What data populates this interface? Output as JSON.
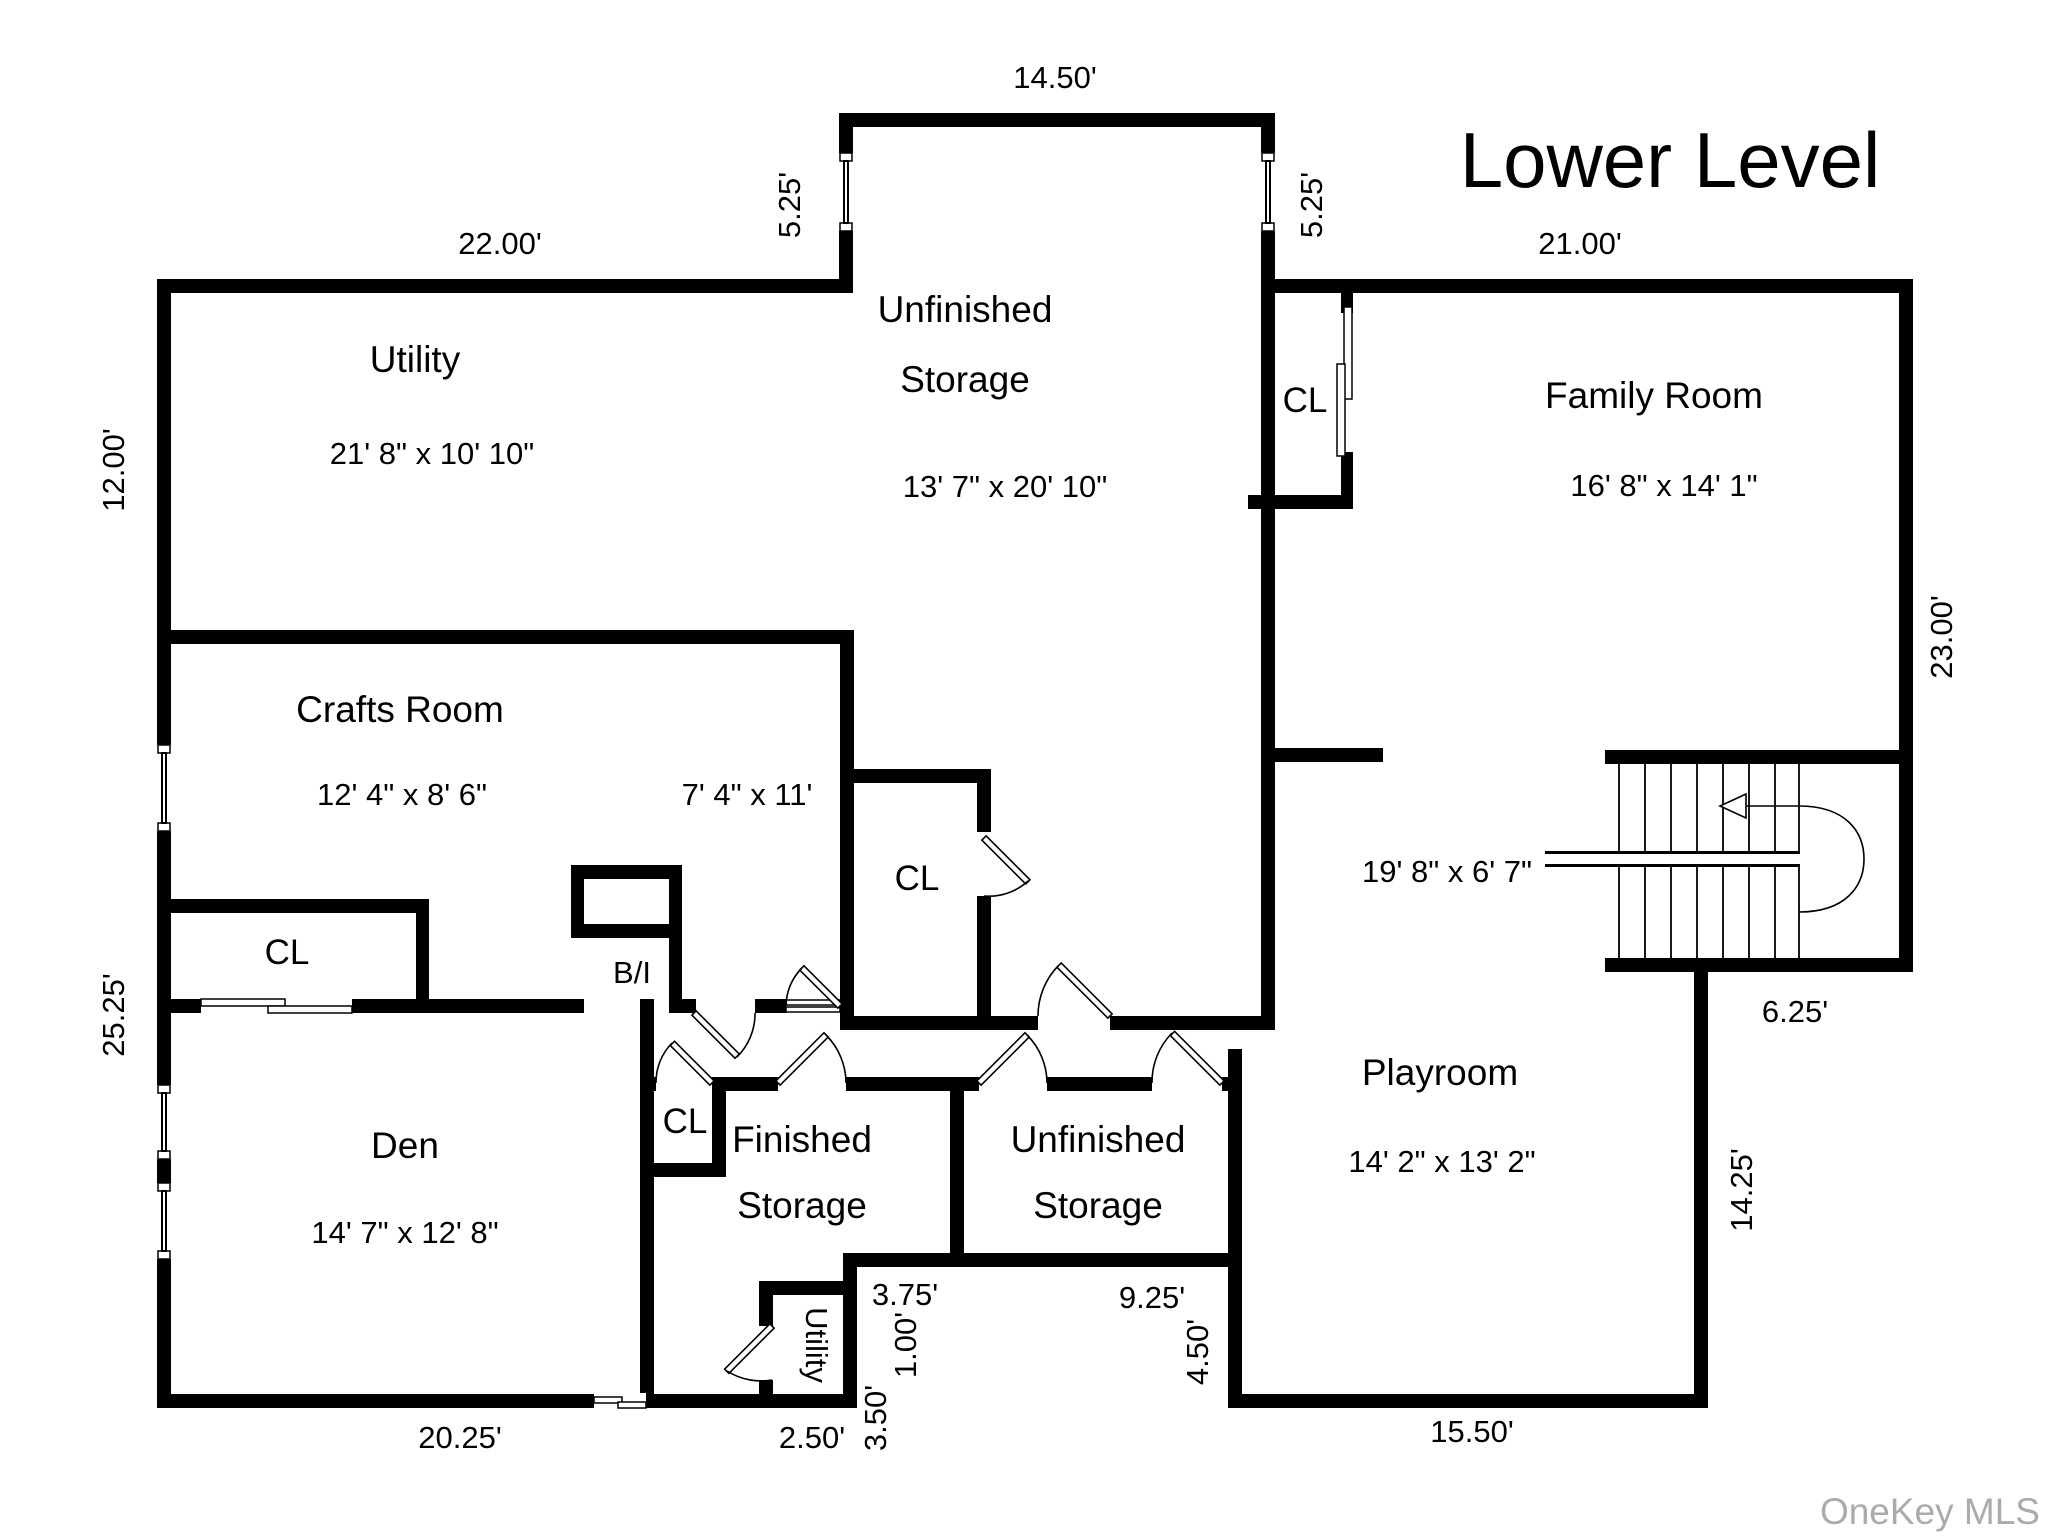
{
  "title": "Lower Level",
  "watermark": "OneKey MLS",
  "rooms": {
    "utility": {
      "name": "Utility",
      "dims": "21' 8\" x 10' 10\""
    },
    "storage_upper": {
      "line1": "Unfinished",
      "line2": "Storage",
      "dims": "13' 7\" x 20' 10\""
    },
    "family": {
      "name": "Family Room",
      "dims": "16' 8\" x 14' 1\""
    },
    "crafts": {
      "name": "Crafts Room",
      "dims": "12' 4\" x 8' 6\""
    },
    "area_7x11": {
      "dims": "7' 4\" x 11'"
    },
    "hall": {
      "dims": "19' 8\" x 6' 7\""
    },
    "den": {
      "name": "Den",
      "dims": "14' 7\" x 12' 8\""
    },
    "playroom": {
      "name": "Playroom",
      "dims": "14' 2\" x 13' 2\""
    },
    "finished_storage": {
      "line1": "Finished",
      "line2": "Storage"
    },
    "unfinished_storage": {
      "line1": "Unfinished",
      "line2": "Storage"
    },
    "utility_closet": {
      "name": "Utility"
    },
    "built_in": {
      "label": "B/I"
    },
    "closet_label": "CL"
  },
  "dimensions": {
    "storage_top": "14.50'",
    "utility_top": "22.00'",
    "family_top": "21.00'",
    "notch_left": "5.25'",
    "notch_right": "5.25'",
    "left_upper": "12.00'",
    "left_lower": "25.25'",
    "right_side": "23.00'",
    "stair_width": "6.25'",
    "playroom_side": "14.25'",
    "den_bottom": "20.25'",
    "utility_closet_bottom": "2.50'",
    "utility_closet_side": "3.50'",
    "storage_jog": "1.00'",
    "storage_bottom_left": "3.75'",
    "storage_bottom_right": "9.25'",
    "storage_side": "4.50'",
    "playroom_bottom": "15.50'"
  }
}
